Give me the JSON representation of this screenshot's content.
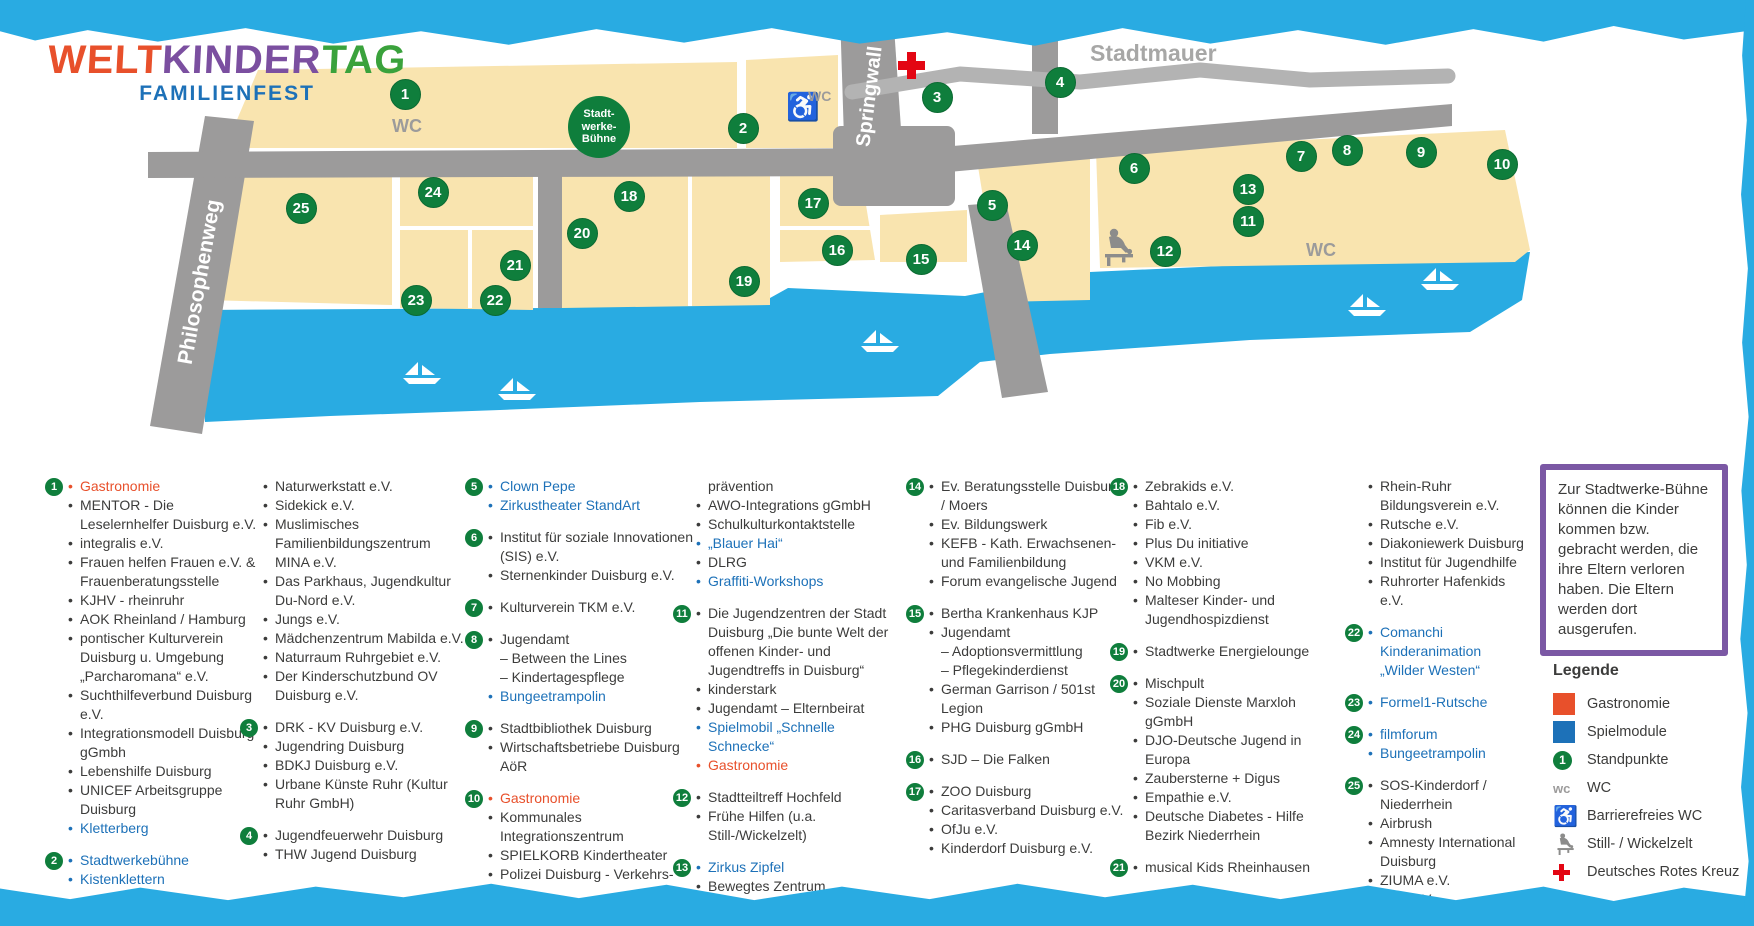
{
  "title": {
    "welt": "WELT",
    "kinder": "KINDER",
    "tag": "TAG",
    "subtitle": "FAMILIENFEST"
  },
  "colors": {
    "cyan": "#29abe2",
    "beige": "#f9e4af",
    "road": "#9c9b9b",
    "wall": "#b3b3b3",
    "green": "#0f7e3c",
    "orange": "#e8502b",
    "blue": "#1d71b8",
    "purple": "#7b58a4",
    "red": "#e30613"
  },
  "map": {
    "labels": {
      "philosophenweg": "Philosophenweg",
      "springwall": "Springwall",
      "stadtmauer": "Stadtmauer",
      "stage_line1": "Stadt-",
      "stage_line2": "werke-",
      "stage_line3": "Bühne",
      "wc_left": "WC",
      "wc_right": "WC",
      "wc_accessible": "WC"
    },
    "markers": [
      {
        "n": 1,
        "x": 404,
        "y": 93
      },
      {
        "n": 2,
        "x": 742,
        "y": 127
      },
      {
        "n": 3,
        "x": 936,
        "y": 96
      },
      {
        "n": 4,
        "x": 1059,
        "y": 81
      },
      {
        "n": 5,
        "x": 991,
        "y": 204
      },
      {
        "n": 6,
        "x": 1133,
        "y": 167
      },
      {
        "n": 7,
        "x": 1300,
        "y": 155
      },
      {
        "n": 8,
        "x": 1346,
        "y": 149
      },
      {
        "n": 9,
        "x": 1420,
        "y": 151
      },
      {
        "n": 10,
        "x": 1501,
        "y": 163
      },
      {
        "n": 11,
        "x": 1247,
        "y": 220
      },
      {
        "n": 12,
        "x": 1164,
        "y": 250
      },
      {
        "n": 13,
        "x": 1247,
        "y": 188
      },
      {
        "n": 14,
        "x": 1021,
        "y": 244
      },
      {
        "n": 15,
        "x": 920,
        "y": 258
      },
      {
        "n": 16,
        "x": 836,
        "y": 249
      },
      {
        "n": 17,
        "x": 812,
        "y": 202
      },
      {
        "n": 18,
        "x": 628,
        "y": 195
      },
      {
        "n": 19,
        "x": 743,
        "y": 280
      },
      {
        "n": 20,
        "x": 581,
        "y": 232
      },
      {
        "n": 21,
        "x": 514,
        "y": 264
      },
      {
        "n": 22,
        "x": 494,
        "y": 299
      },
      {
        "n": 23,
        "x": 415,
        "y": 299
      },
      {
        "n": 24,
        "x": 432,
        "y": 191
      },
      {
        "n": 25,
        "x": 300,
        "y": 207
      }
    ]
  },
  "columns": [
    [
      {
        "num": "1",
        "entries": [
          {
            "t": "Gastronomie",
            "c": "orange"
          },
          {
            "t": "MENTOR - Die Leselernhelfer Duisburg e.V."
          },
          {
            "t": "integralis e.V."
          },
          {
            "t": "Frauen helfen Frauen e.V. & Frauenberatungsstelle"
          },
          {
            "t": "KJHV - rheinruhr"
          },
          {
            "t": "AOK Rheinland / Hamburg"
          },
          {
            "t": "pontischer Kulturverein Duisburg u. Umgebung „Parcharomana“ e.V."
          },
          {
            "t": "Suchthilfeverbund Duisburg e.V."
          },
          {
            "t": "Integrationsmodell Duisburg gGmbh"
          },
          {
            "t": "Lebenshilfe Duisburg"
          },
          {
            "t": "UNICEF Arbeitsgruppe Duisburg"
          },
          {
            "t": "Kletterberg",
            "c": "blue"
          }
        ]
      },
      {
        "num": "2",
        "entries": [
          {
            "t": "Stadtwerkebühne",
            "c": "blue"
          },
          {
            "t": "Kistenklettern",
            "c": "blue"
          }
        ]
      }
    ],
    [
      {
        "num": null,
        "entries": [
          {
            "t": "Naturwerkstatt e.V."
          },
          {
            "t": "Sidekick e.V."
          },
          {
            "t": "Muslimisches Familienbildungszentrum MINA e.V."
          },
          {
            "t": "Das Parkhaus, Jugendkultur Du-Nord e.V."
          },
          {
            "t": "Jungs e.V."
          },
          {
            "t": "Mädchenzentrum Mabilda e.V."
          },
          {
            "t": "Naturraum Ruhrgebiet e.V."
          },
          {
            "t": "Der Kinderschutzbund OV Duisburg e.V."
          }
        ]
      },
      {
        "num": "3",
        "entries": [
          {
            "t": "DRK - KV Duisburg e.V."
          },
          {
            "t": "Jugendring Duisburg"
          },
          {
            "t": "BDKJ Duisburg e.V."
          },
          {
            "t": "Urbane Künste Ruhr (Kultur Ruhr GmbH)"
          }
        ]
      },
      {
        "num": "4",
        "entries": [
          {
            "t": "Jugendfeuerwehr Duisburg"
          },
          {
            "t": "THW Jugend Duisburg"
          }
        ]
      }
    ],
    [
      {
        "num": "5",
        "entries": [
          {
            "t": "Clown Pepe",
            "c": "blue"
          },
          {
            "t": "Zirkustheater StandArt",
            "c": "blue"
          }
        ]
      },
      {
        "num": "6",
        "entries": [
          {
            "t": "Institut für soziale Innovationen (SIS) e.V."
          },
          {
            "t": "Sternenkinder Duisburg e.V."
          }
        ]
      },
      {
        "num": "7",
        "entries": [
          {
            "t": "Kulturverein TKM e.V."
          }
        ]
      },
      {
        "num": "8",
        "entries": [
          {
            "t": "Jugendamt"
          },
          {
            "t": "– Between the Lines",
            "nb": true
          },
          {
            "t": "– Kindertagespflege",
            "nb": true
          },
          {
            "t": "Bungeetrampolin",
            "c": "blue"
          }
        ]
      },
      {
        "num": "9",
        "entries": [
          {
            "t": "Stadtbibliothek Duisburg"
          },
          {
            "t": "Wirtschaftsbetriebe Duisburg AöR"
          }
        ]
      },
      {
        "num": "10",
        "entries": [
          {
            "t": "Gastronomie",
            "c": "orange"
          },
          {
            "t": "Kommunales Integrationszentrum"
          },
          {
            "t": "SPIELKORB Kindertheater"
          },
          {
            "t": "Polizei Duisburg - Verkehrs-"
          }
        ]
      }
    ],
    [
      {
        "num": null,
        "entries": [
          {
            "t": "prävention",
            "nb": true
          },
          {
            "t": "AWO-Integrations gGmbH"
          },
          {
            "t": "Schulkulturkontaktstelle"
          },
          {
            "t": "„Blauer Hai“",
            "c": "blue"
          },
          {
            "t": "DLRG"
          },
          {
            "t": "Graffiti-Workshops",
            "c": "blue"
          }
        ]
      },
      {
        "num": "11",
        "entries": [
          {
            "t": "Die Jugendzentren der Stadt Duisburg „Die bunte Welt der offenen Kinder- und Jugendtreffs in Duisburg“"
          },
          {
            "t": "kinderstark"
          },
          {
            "t": "Jugendamt – Elternbeirat"
          },
          {
            "t": "Spielmobil „Schnelle Schnecke“",
            "c": "blue"
          },
          {
            "t": "Gastronomie",
            "c": "orange"
          }
        ]
      },
      {
        "num": "12",
        "entries": [
          {
            "t": "Stadtteiltreff Hochfeld"
          },
          {
            "t": "Frühe Hilfen (u.a. Still-/Wickelzelt)"
          }
        ]
      },
      {
        "num": "13",
        "entries": [
          {
            "t": "Zirkus Zipfel",
            "c": "blue"
          },
          {
            "t": "Bewegtes Zentrum"
          }
        ]
      }
    ],
    [
      {
        "num": "14",
        "entries": [
          {
            "t": "Ev. Beratungsstelle Duisburg / Moers"
          },
          {
            "t": "Ev. Bildungswerk"
          },
          {
            "t": "KEFB - Kath. Erwachsenen- und Familienbildung"
          },
          {
            "t": "Forum evangelische Jugend"
          }
        ]
      },
      {
        "num": "15",
        "entries": [
          {
            "t": "Bertha Krankenhaus KJP"
          },
          {
            "t": "Jugendamt"
          },
          {
            "t": "– Adoptionsvermittlung",
            "nb": true
          },
          {
            "t": "– Pflegekinderdienst",
            "nb": true
          },
          {
            "t": "German Garrison / 501st Legion"
          },
          {
            "t": "PHG Duisburg gGmbH"
          }
        ]
      },
      {
        "num": "16",
        "entries": [
          {
            "t": "SJD – Die Falken"
          }
        ]
      },
      {
        "num": "17",
        "entries": [
          {
            "t": "ZOO Duisburg"
          },
          {
            "t": "Caritasverband Duisburg e.V."
          },
          {
            "t": "OfJu e.V."
          },
          {
            "t": "Kinderdorf Duisburg e.V."
          }
        ]
      }
    ],
    [
      {
        "num": "18",
        "entries": [
          {
            "t": "Zebrakids e.V."
          },
          {
            "t": "Bahtalo e.V."
          },
          {
            "t": "Fib e.V."
          },
          {
            "t": "Plus Du initiative"
          },
          {
            "t": "VKM e.V."
          },
          {
            "t": "No Mobbing"
          },
          {
            "t": "Malteser Kinder- und Jugendhospizdienst"
          }
        ]
      },
      {
        "num": "19",
        "entries": [
          {
            "t": "Stadtwerke Energielounge"
          }
        ]
      },
      {
        "num": "20",
        "entries": [
          {
            "t": "Mischpult"
          },
          {
            "t": "Soziale Dienste Marxloh gGmbH"
          },
          {
            "t": "DJO-Deutsche Jugend in Europa"
          },
          {
            "t": "Zaubersterne + Digus"
          },
          {
            "t": "Empathie e.V."
          },
          {
            "t": "Deutsche Diabetes - Hilfe Bezirk Niederrhein"
          }
        ]
      },
      {
        "num": "21",
        "entries": [
          {
            "t": "musical Kids Rheinhausen"
          }
        ]
      }
    ],
    [
      {
        "num": null,
        "entries": [
          {
            "t": "Rhein-Ruhr Bildungsverein e.V."
          },
          {
            "t": "Rutsche e.V."
          },
          {
            "t": "Diakoniewerk Duisburg"
          },
          {
            "t": "Institut für Jugendhilfe"
          },
          {
            "t": "Ruhrorter Hafenkids e.V."
          }
        ]
      },
      {
        "num": "22",
        "entries": [
          {
            "t": "Comanchi Kinderanimation „Wilder Westen“",
            "c": "blue"
          }
        ]
      },
      {
        "num": "23",
        "entries": [
          {
            "t": "Formel1-Rutsche",
            "c": "blue"
          }
        ]
      },
      {
        "num": "24",
        "entries": [
          {
            "t": "filmforum",
            "c": "blue"
          },
          {
            "t": "Bungeetrampolin",
            "c": "blue"
          }
        ]
      },
      {
        "num": "25",
        "entries": [
          {
            "t": "SOS-Kinderdorf / Niederrhein"
          },
          {
            "t": "Airbrush"
          },
          {
            "t": "Amnesty International Duisburg"
          },
          {
            "t": "ZIUMA e.V."
          },
          {
            "t": "WiR e.V."
          }
        ]
      }
    ]
  ],
  "note_box": {
    "text": "Zur Stadtwerke-Bühne können die Kinder kommen bzw. gebracht werden, die ihre Eltern verloren haben. Die Eltern werden dort ausgerufen."
  },
  "legend": {
    "title": "Legende",
    "items": [
      {
        "icon": "square-gastronomie",
        "label": "Gastronomie"
      },
      {
        "icon": "square-spielmodule",
        "label": "Spielmodule"
      },
      {
        "icon": "badge-standpunkte",
        "badge_number": "1",
        "label": "Standpunkte"
      },
      {
        "icon": "wc-text",
        "wc_text": "wc",
        "label": "WC"
      },
      {
        "icon": "wheelchair-icon",
        "label": "Barrierefreies WC"
      },
      {
        "icon": "nursing-icon",
        "label": "Still- / Wickelzelt"
      },
      {
        "icon": "red-cross-icon",
        "label": "Deutsches Rotes Kreuz"
      }
    ]
  }
}
